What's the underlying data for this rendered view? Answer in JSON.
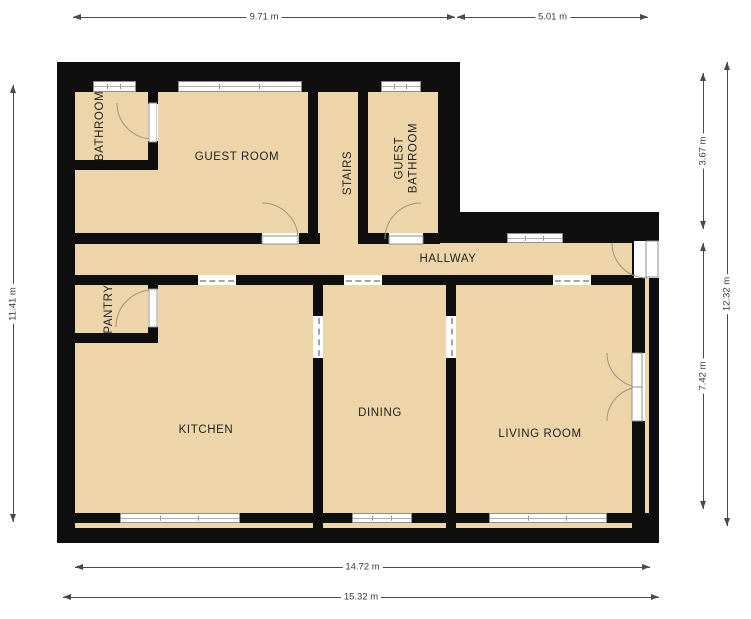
{
  "rooms": [
    {
      "label": "BATHROOM"
    },
    {
      "label": "GUEST ROOM"
    },
    {
      "label": "STAIRS"
    },
    {
      "label": "GUEST BATHROOM"
    },
    {
      "label": "HALLWAY"
    },
    {
      "label": "PANTRY"
    },
    {
      "label": "KITCHEN"
    },
    {
      "label": "DINING"
    },
    {
      "label": "LIVING ROOM"
    }
  ],
  "dims": [
    {
      "label": "9.71 m"
    },
    {
      "label": "5.01 m"
    },
    {
      "label": "11.41 m"
    },
    {
      "label": "3.67 m"
    },
    {
      "label": "7.42 m"
    },
    {
      "label": "12.32 m"
    },
    {
      "label": "14.72 m"
    },
    {
      "label": "15.32 m"
    }
  ],
  "colors": {
    "floor": "#eed5a9",
    "wall": "#0e0e0e",
    "window_frame": "#8f8f8f",
    "door_arc": "#9a9083",
    "dimension": "#4a4a4a",
    "label_text": "#222222"
  }
}
